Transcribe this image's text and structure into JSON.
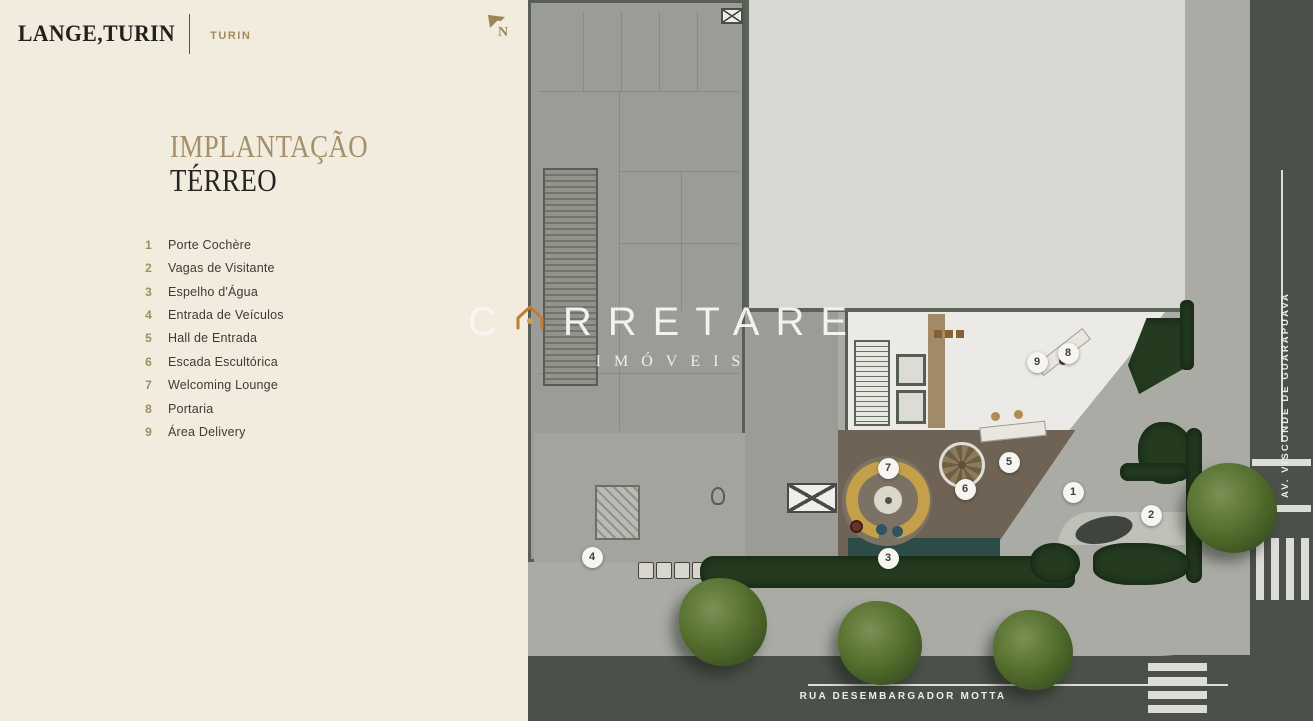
{
  "header": {
    "logo": "LANGE,TURIN",
    "brand_tag": "TURIN"
  },
  "title": {
    "line1": "IMPLANTAÇÃO",
    "line2": "TÉRREO"
  },
  "legend": {
    "items": [
      {
        "num": "1",
        "label": "Porte Cochère"
      },
      {
        "num": "2",
        "label": "Vagas de Visitante"
      },
      {
        "num": "3",
        "label": "Espelho d'Água"
      },
      {
        "num": "4",
        "label": "Entrada de Veículos"
      },
      {
        "num": "5",
        "label": "Hall de Entrada"
      },
      {
        "num": "6",
        "label": "Escada Escultórica"
      },
      {
        "num": "7",
        "label": "Welcoming Lounge"
      },
      {
        "num": "8",
        "label": "Portaria"
      },
      {
        "num": "9",
        "label": "Área Delivery"
      }
    ]
  },
  "plan": {
    "north_label": "N",
    "streets": {
      "bottom": "RUA DESEMBARGADOR MOTTA",
      "right": "AV. VISCONDE DE GUARAPUAVA"
    },
    "markers": [
      {
        "num": "1",
        "x": 545,
        "y": 492
      },
      {
        "num": "2",
        "x": 623,
        "y": 515
      },
      {
        "num": "3",
        "x": 360,
        "y": 558
      },
      {
        "num": "4",
        "x": 64,
        "y": 557
      },
      {
        "num": "5",
        "x": 481,
        "y": 462
      },
      {
        "num": "6",
        "x": 437,
        "y": 489
      },
      {
        "num": "7",
        "x": 360,
        "y": 468
      },
      {
        "num": "8",
        "x": 540,
        "y": 353
      },
      {
        "num": "9",
        "x": 509,
        "y": 362
      }
    ]
  },
  "watermark": {
    "left": "C",
    "right": "RRETARE",
    "line2": "IMÓVEIS",
    "icon": "house-icon"
  },
  "colors": {
    "cream": "#f1ecdd",
    "accent_gold": "#a28c60",
    "title_gold": "#a5906b",
    "street": "#4b504a",
    "sidewalk": "#aaaba5",
    "building_gray": "#9b9c97",
    "slab_gray": "#d7d8d3",
    "wall_olive": "#575e53",
    "deck_wood": "#6e6354",
    "sofa_gold": "#c5a04b",
    "water_teal": "#2d4b47",
    "hedge_green": "#243b20",
    "marker_bg": "#f6f5f1"
  }
}
